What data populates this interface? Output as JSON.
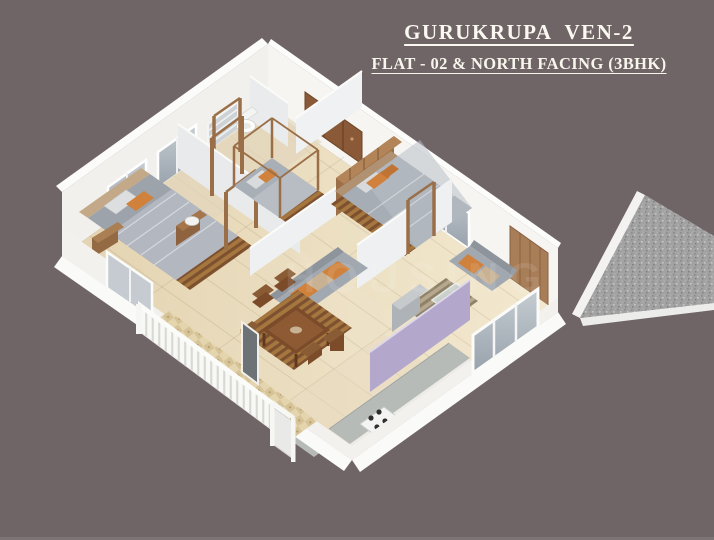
{
  "header": {
    "title": "GURUKRUPA  VEN-2",
    "subtitle": "FLAT - 02 & NORTH FACING (3BHK)"
  },
  "watermark": {
    "text": "HOUSING"
  },
  "palette": {
    "background": "#6f6566",
    "title_text": "#faf8f0",
    "floor_marble": "#ecdfc2",
    "wall_white": "#f2f1ee",
    "interior_wall": "#e9eaeb",
    "wood_door_brown": "#9a6f48",
    "rug_mat_brown": "#8a5c36",
    "bedding_gray": "#a0a6ae",
    "cushion_orange": "#d0813c",
    "cushion_beige": "#c9b294",
    "kitchen_lilac": "#b3a8cb",
    "sink_lilac": "#c2b3da",
    "counter_granite": "#b7bbb7",
    "passage_granite": "#a3a2a2",
    "glass_gray": "#aab3bb",
    "balcony_tile": "#e4d5ae"
  }
}
